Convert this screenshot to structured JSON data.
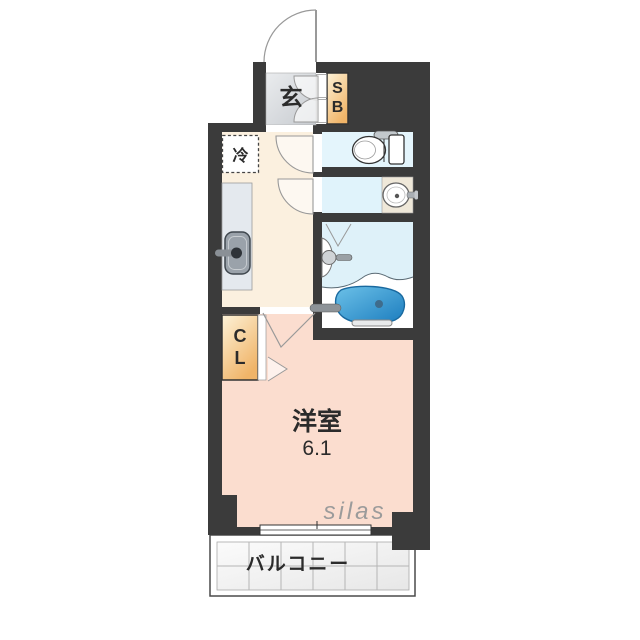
{
  "floorplan": {
    "watermark": "silas",
    "colors": {
      "wall": "#3b3b3b",
      "outline": "#555555",
      "door_line": "#999999",
      "entrance_floor_light": "#eaecee",
      "entrance_floor_dark": "#c7cbd0",
      "cabinet_light": "#fdf2d8",
      "cabinet_dark": "#f0b468",
      "kitchen_floor": "#fbf0df",
      "room_floor": "#fbddcf",
      "toilet_floor": "#e4f5fc",
      "washroom_floor": "#e0f3fb",
      "bath_floor": "#def1f9",
      "counter": "#e4e9ee",
      "sink": "#9aa2aa",
      "basin_counter": "#efe8d9",
      "tub_light": "#6cc1e8",
      "tub_dark": "#1b7cbe",
      "tile_light": "#fbfbfb",
      "tile_dark": "#e7e7e7",
      "watermark": "#9b9b9b",
      "label": "#2b2b2b"
    },
    "rooms": {
      "entrance": {
        "label": "玄"
      },
      "shoe_box": {
        "letters": [
          "S",
          "B"
        ]
      },
      "refrigerator": {
        "label": "冷"
      },
      "closet": {
        "letters": [
          "C",
          "L"
        ]
      },
      "western_room": {
        "label": "洋室",
        "size": "6.1"
      },
      "balcony": {
        "label": "バルコニー"
      }
    }
  }
}
